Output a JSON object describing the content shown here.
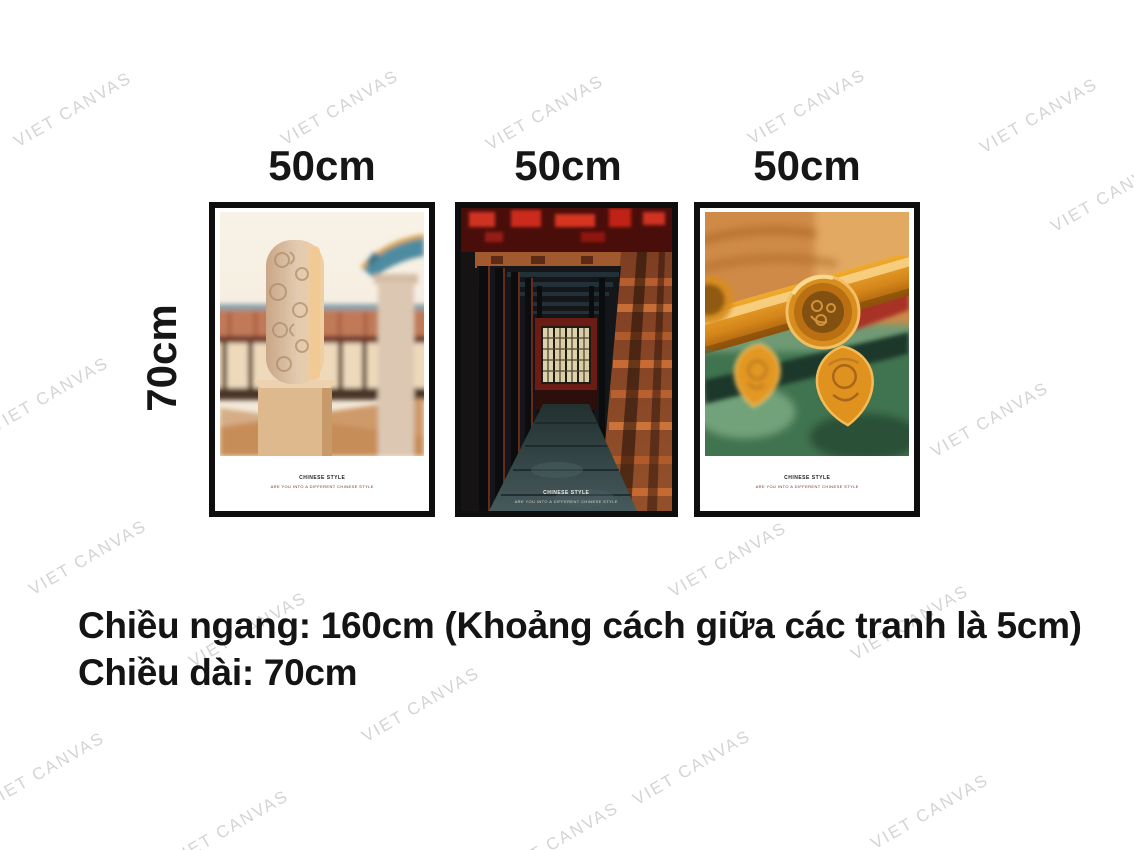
{
  "watermark": {
    "text": "VIET CANVAS",
    "color": "#d4d4d4"
  },
  "size_labels": {
    "widths": [
      "50cm",
      "50cm",
      "50cm"
    ],
    "height": "70cm"
  },
  "posters": [
    {
      "caption_title": "CHINESE STYLE",
      "caption_subtitle": "ARE YOU INTO A DIFFERENT CHINESE STYLE",
      "photo_alt": "carved stone pillar in front of chinese palace roof"
    },
    {
      "caption_title": "CHINESE STYLE",
      "caption_subtitle": "ARE YOU INTO A DIFFERENT CHINESE STYLE",
      "photo_alt": "dark red corridor of chinese palace with lattice window"
    },
    {
      "caption_title": "CHINESE STYLE",
      "caption_subtitle": "ARE YOU INTO A DIFFERENT CHINESE STYLE",
      "photo_alt": "glazed yellow roof eave tiles close-up on green background"
    }
  ],
  "footer": {
    "line1": "Chiều ngang: 160cm (Khoảng cách giữa các tranh là 5cm)",
    "line2": "Chiều dài: 70cm"
  },
  "colors": {
    "text": "#161616",
    "frame": "#0e0e0e",
    "caption_subtitle": "#7d2c1d"
  }
}
